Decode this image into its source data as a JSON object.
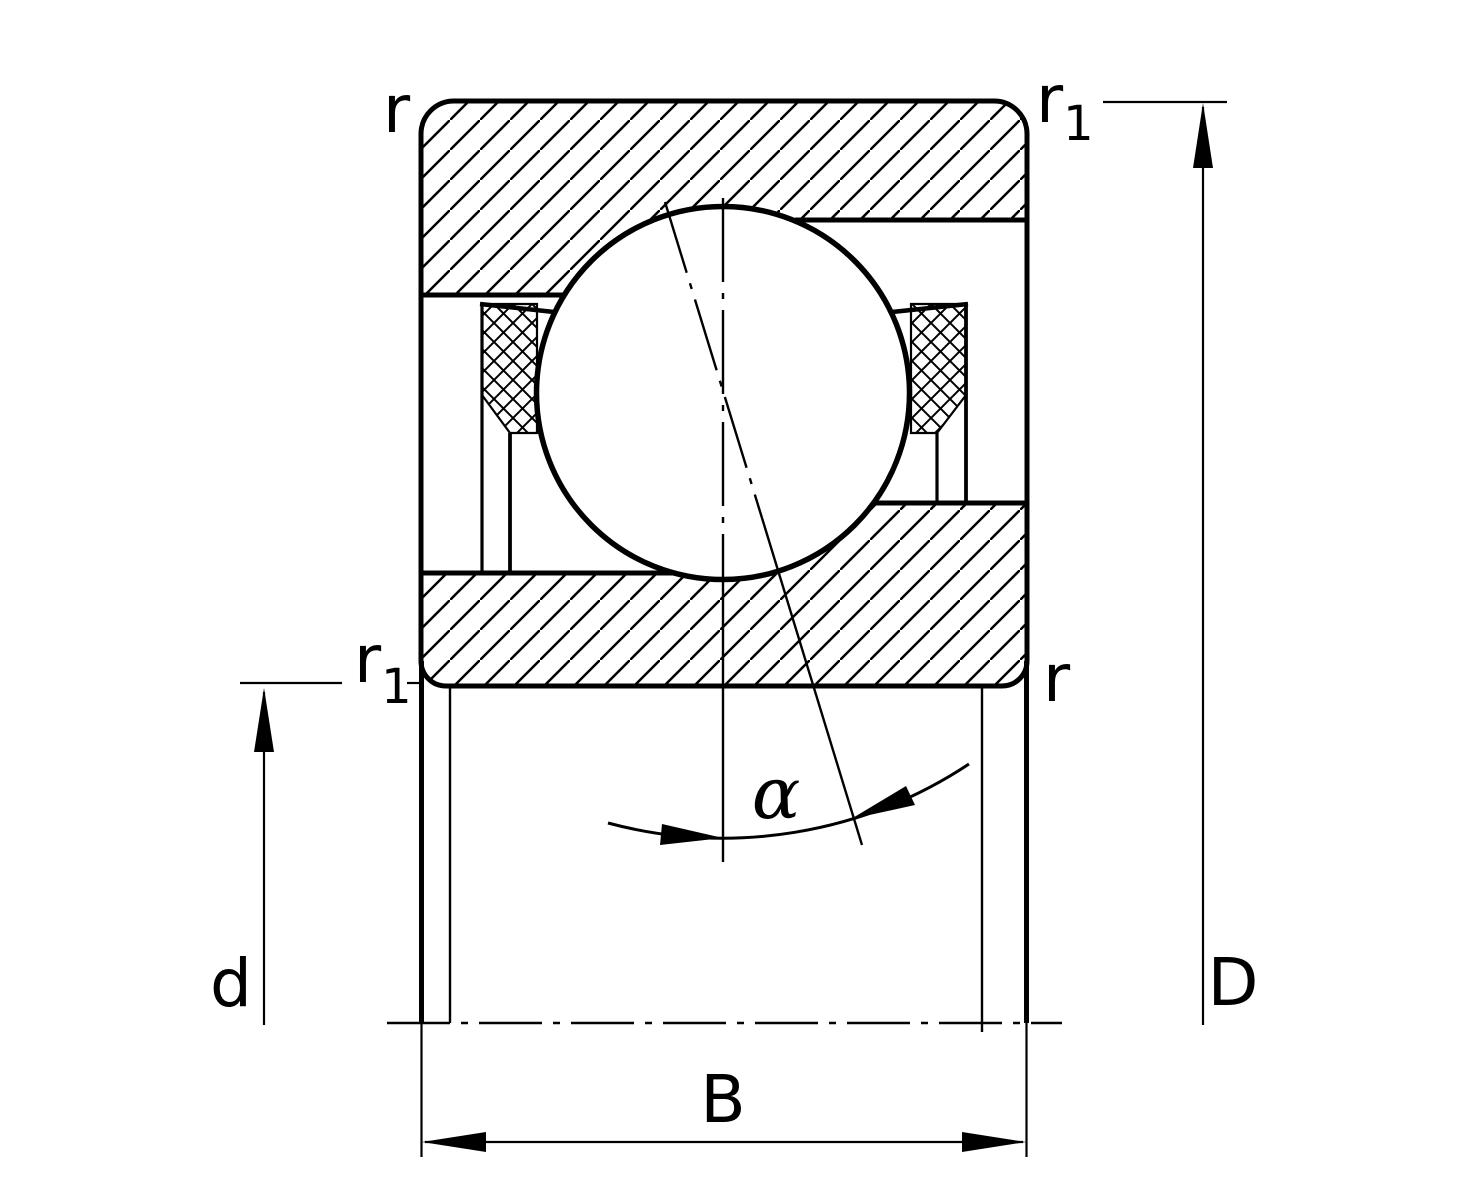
{
  "figure": {
    "description": "Angular contact ball bearing cross-section with dimension symbols"
  },
  "colors": {
    "line": "#000000",
    "background": "#ffffff"
  },
  "labels": {
    "edge_radius_top_left": "r",
    "edge_radius_top_right": {
      "base": "r",
      "sub": "1"
    },
    "edge_radius_mid_left": {
      "base": "r",
      "sub": "1"
    },
    "edge_radius_mid_right": "r",
    "bore_diameter": "d",
    "outer_diameter": "D",
    "width": "B",
    "contact_angle": "α"
  }
}
